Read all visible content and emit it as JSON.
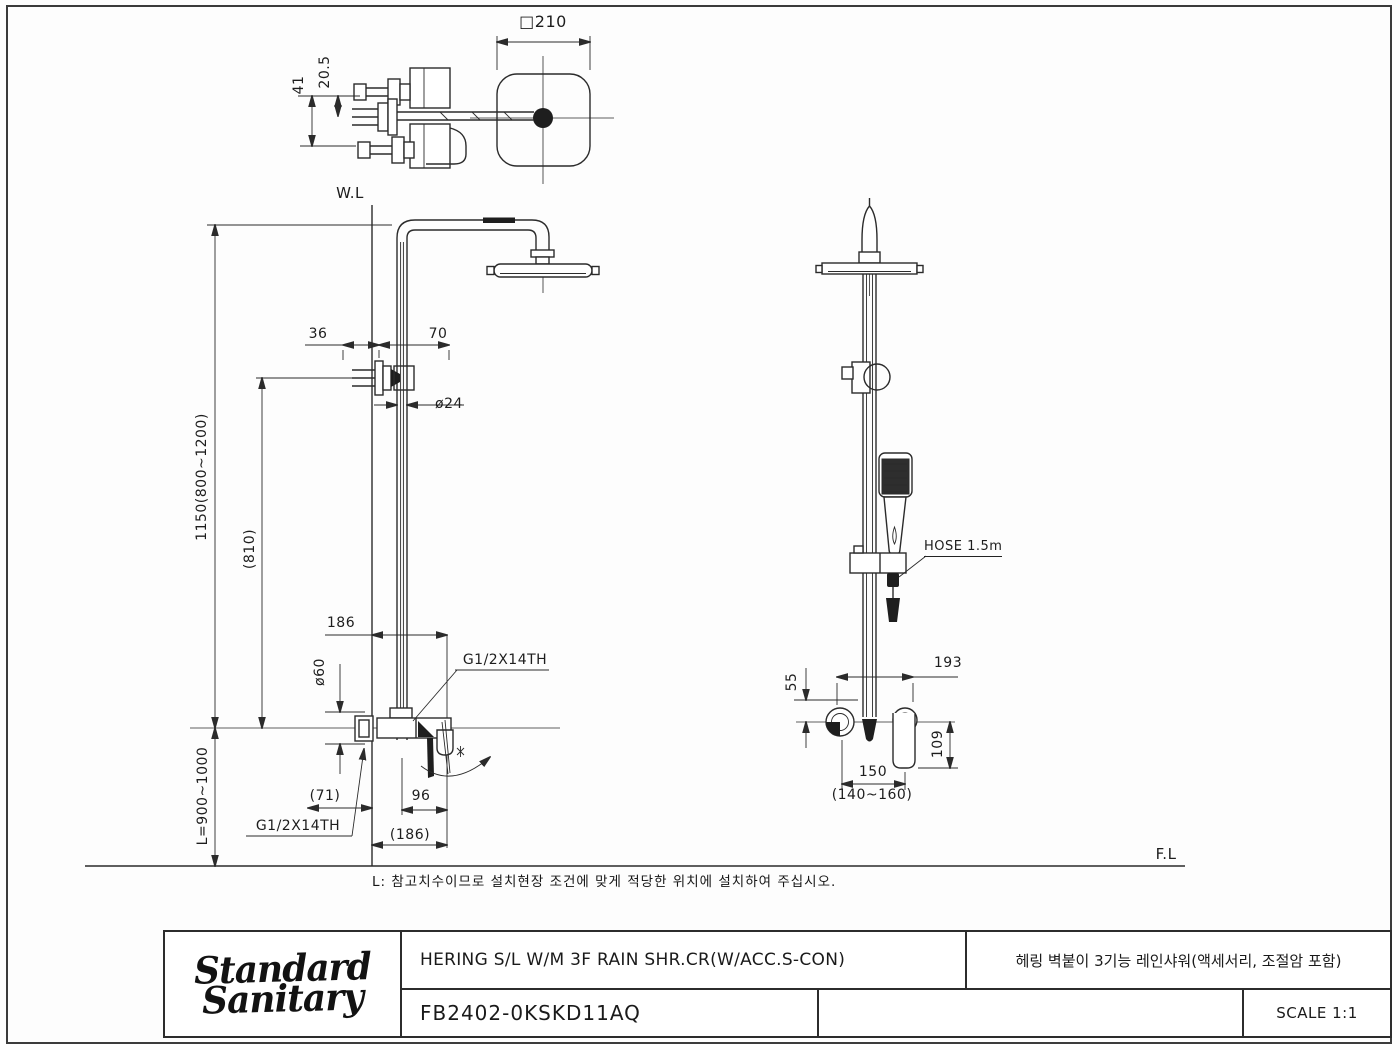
{
  "sheet": {
    "wl_label": "W.L",
    "fl_label": "F.L",
    "note": "L: 참고치수이므로 설치현장 조건에 맞게 적당한 위치에 설치하여 주십시오."
  },
  "top_view": {
    "square_size": "□210",
    "d41": "41",
    "d20_5": "20.5"
  },
  "front_view": {
    "d36": "36",
    "d70": "70",
    "dia24": "ø24",
    "h1150": "1150(800~1200)",
    "h810": "(810)",
    "d186": "186",
    "dia60": "ø60",
    "thread_upper": "G1/2X14TH",
    "d71": "(71)",
    "d96": "96",
    "thread_lower": "G1/2X14TH",
    "d186_paren": "(186)",
    "l_range": "L=900~1000"
  },
  "side_view": {
    "hose": "HOSE 1.5m",
    "d55": "55",
    "d193": "193",
    "d109": "109",
    "d150": "150",
    "d140_160": "(140~160)"
  },
  "title_block": {
    "logo_line1": "Standard",
    "logo_line2": "Sanitary",
    "product_title_en": "HERING S/L W/M 3F RAIN SHR.CR(W/ACC.S-CON)",
    "product_title_ko": "헤링 벽붙이 3기능 레인샤워(액세서리, 조절암 포함)",
    "model_code": "FB2402-0KSKD11AQ",
    "scale_label": "SCALE 1:1"
  }
}
